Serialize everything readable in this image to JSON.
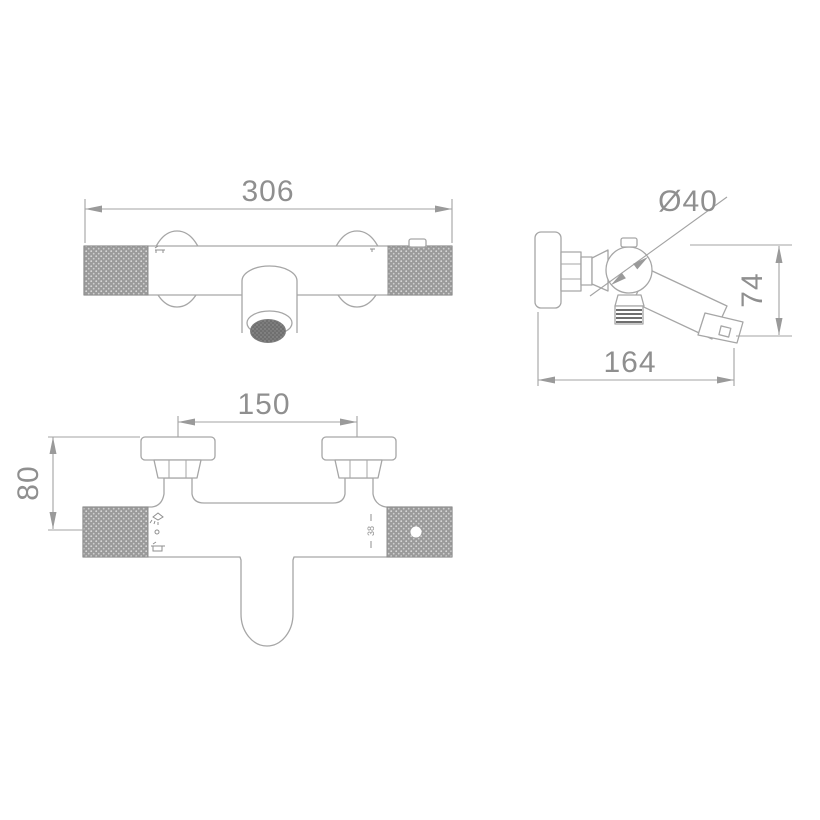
{
  "colors": {
    "background": "#ffffff",
    "line": "#a6a6a6",
    "dimension_text": "#8f8f8f",
    "knurl_fill": "#9a9a9a",
    "aerator_fill": "#6f6f6f"
  },
  "dimensions": {
    "front_width": "306",
    "handle_diameter": "Ø40",
    "side_height": "74",
    "side_depth": "164",
    "union_centers": "150",
    "wall_offset": "80"
  },
  "markings": {
    "temperature_stop": "38"
  }
}
